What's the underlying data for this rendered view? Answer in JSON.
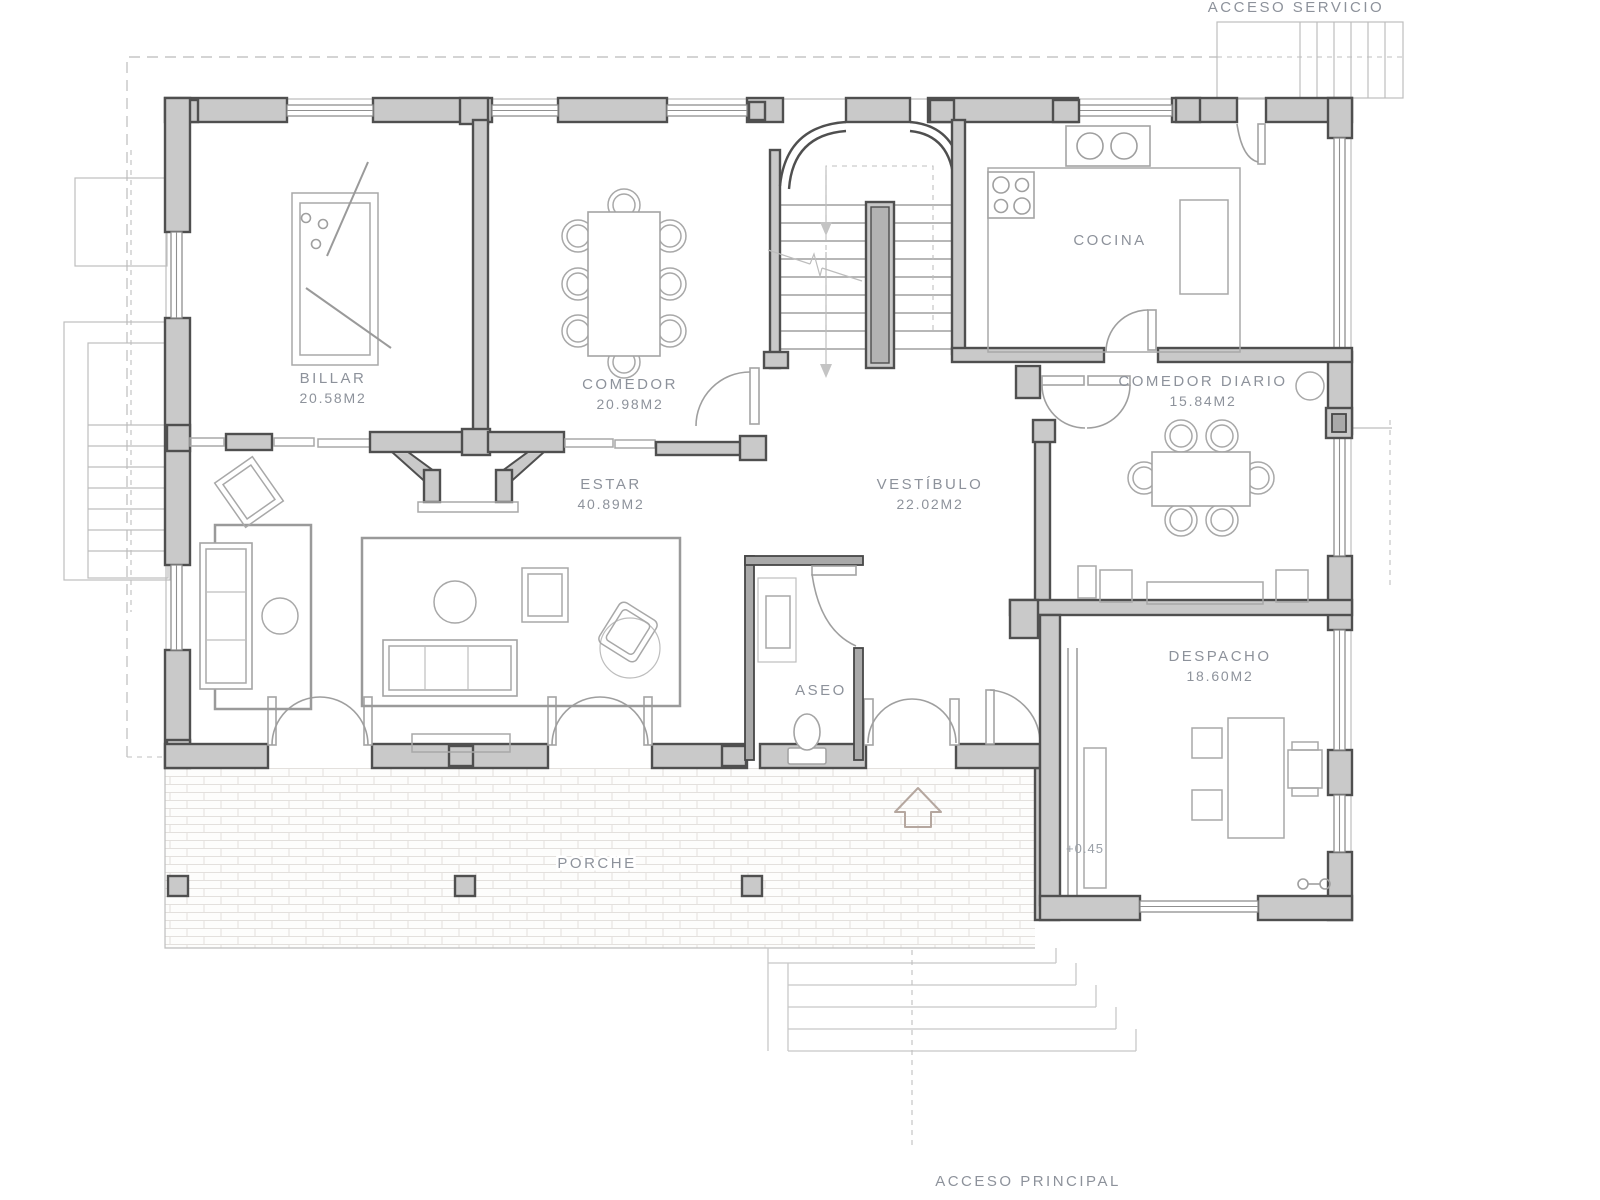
{
  "plan": {
    "rooms": [
      {
        "name": "BILLAR",
        "area": "20.58M2"
      },
      {
        "name": "COMEDOR",
        "area": "20.98M2"
      },
      {
        "name": "ESTAR",
        "area": "40.89M2"
      },
      {
        "name": "VESTÍBULO",
        "area": "22.02M2"
      },
      {
        "name": "COCINA",
        "area": ""
      },
      {
        "name": "COMEDOR DIARIO",
        "area": "15.84M2"
      },
      {
        "name": "DESPACHO",
        "area": "18.60M2"
      },
      {
        "name": "ASEO",
        "area": ""
      },
      {
        "name": "PORCHE",
        "area": ""
      }
    ],
    "annotations": {
      "service_access": "ACCESO SERVICIO",
      "main_access": "ACCESO PRINCIPAL",
      "level_mark": "+0.45"
    },
    "colors": {
      "wall_fill": "#c9c9c9",
      "wall_stroke": "#4f4f4f",
      "line": "#9f9f9f",
      "text": "#8d929b",
      "brick_line": "#e3e0dd",
      "entry_arrow": "#b5a79f"
    }
  }
}
